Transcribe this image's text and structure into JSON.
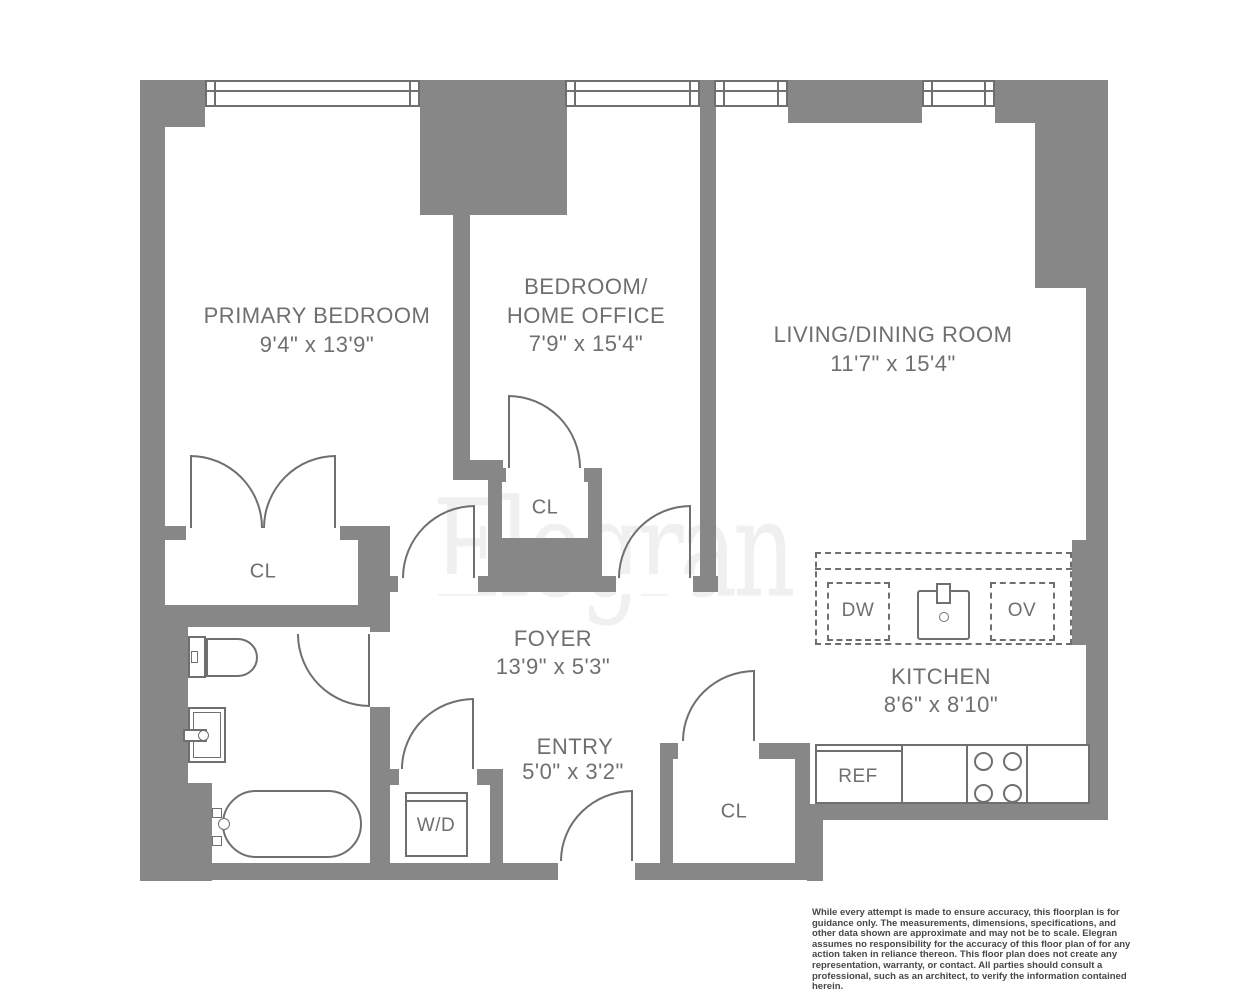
{
  "colors": {
    "wall": "#878787",
    "line": "#6f6f6f",
    "text": "#6f6f6f",
    "watermark": "#f0f0f0",
    "disclaimer": "#484848"
  },
  "watermark": "Elegran",
  "rooms": {
    "primary": {
      "name": "PRIMARY BEDROOM",
      "dims": "9'4\" x 13'9\""
    },
    "office": {
      "name_line1": "BEDROOM/",
      "name_line2": "HOME OFFICE",
      "dims": "7'9\" x 15'4\""
    },
    "living": {
      "name": "LIVING/DINING ROOM",
      "dims": "11'7\" x 15'4\""
    },
    "foyer": {
      "name": "FOYER",
      "dims": "13'9\" x 5'3\""
    },
    "entry": {
      "name": "ENTRY",
      "dims": "5'0\" x 3'2\""
    },
    "kitchen": {
      "name": "KITCHEN",
      "dims": "8'6\" x 8'10\""
    }
  },
  "labels": {
    "closet": "CL",
    "washer_dryer": "W/D",
    "dishwasher": "DW",
    "oven": "OV",
    "refrigerator": "REF"
  },
  "disclaimer": "While every attempt is made to ensure accuracy, this floorplan is for guidance only. The measurements, dimensions, specifications, and other data shown are approximate and may not be to scale. Elegran assumes no responsibility for the accuracy of this floor plan of for any action taken in reliance thereon. This floor plan does not create any representation, warranty, or contact. All parties should consult a professional, such as an architect, to verify the information contained herein."
}
